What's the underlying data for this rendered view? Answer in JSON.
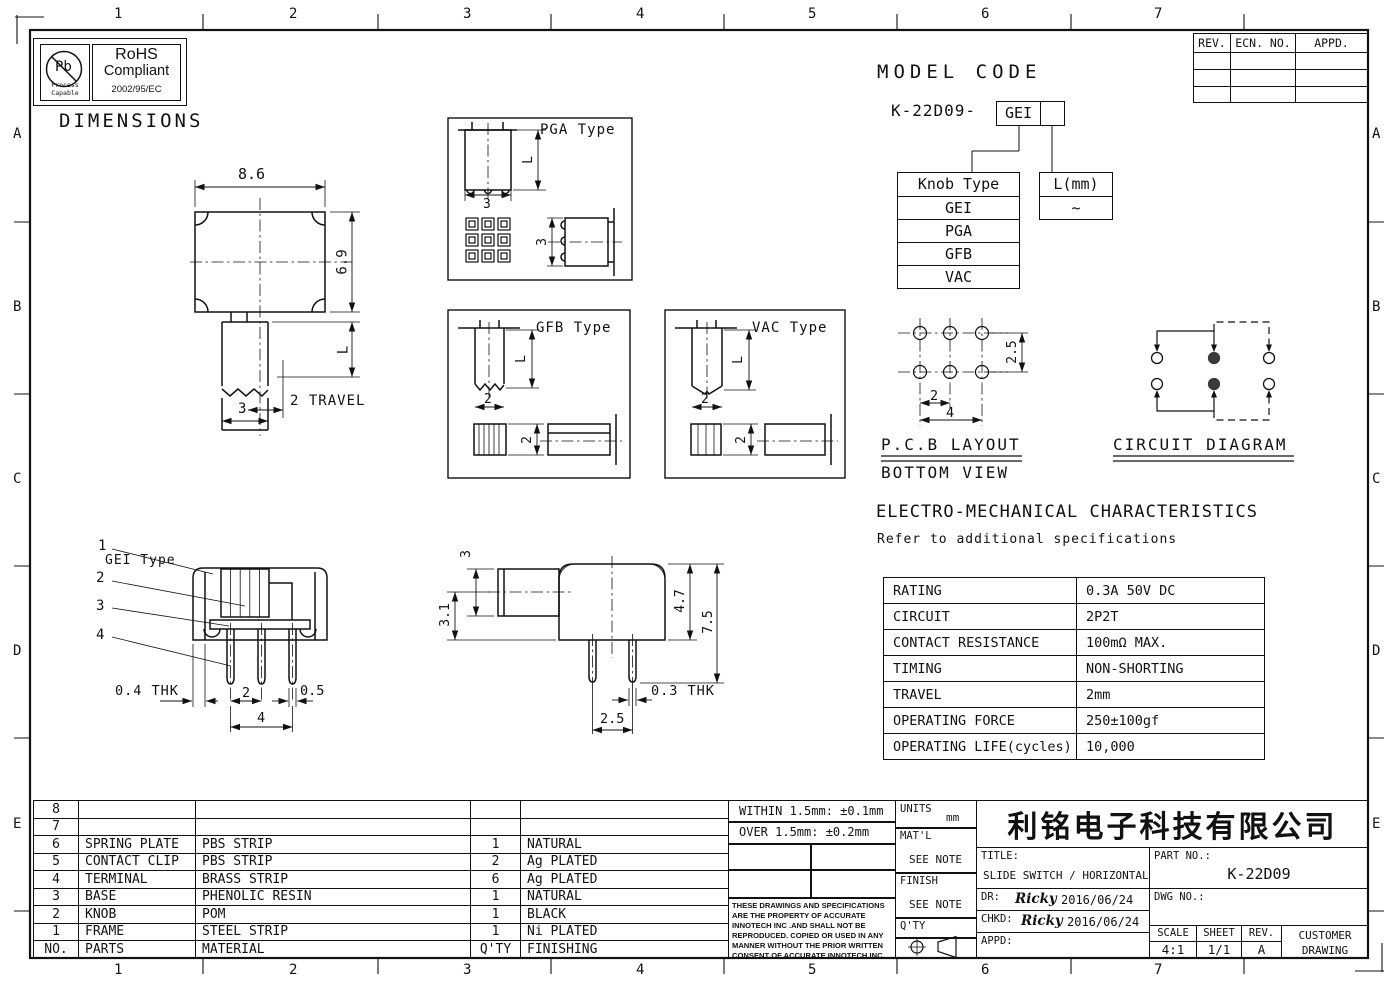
{
  "sheet": {
    "heading": "DIMENSIONS",
    "zone_cols": [
      "1",
      "2",
      "3",
      "4",
      "5",
      "6",
      "7"
    ],
    "zone_rows": [
      "A",
      "B",
      "C",
      "D",
      "E"
    ]
  },
  "rohs": {
    "symbol": "Pb",
    "process": "Process",
    "capable": "Capable",
    "title": "RoHS",
    "subtitle": "Compliant",
    "directive": "2002/95/EC"
  },
  "rev_table": {
    "rev": "REV.",
    "ecn": "ECN. NO.",
    "appd": "APPD."
  },
  "model_code": {
    "heading": "MODEL CODE",
    "base": "K-22D09-",
    "selected_knob": "GEI",
    "knob_table": {
      "header": "Knob Type",
      "options": [
        "GEI",
        "PGA",
        "GFB",
        "VAC"
      ]
    },
    "length_table": {
      "header": "L(mm)",
      "value": "~"
    }
  },
  "views": {
    "top_view": {
      "body_width": "8.6",
      "body_height": "6.9",
      "stem_len": "L",
      "travel": "2 TRAVEL",
      "stem_width": "3"
    },
    "pga": {
      "label": "PGA Type",
      "stem_len": "L",
      "stem_width": "3",
      "side_width": "3"
    },
    "gfb": {
      "label": "GFB Type",
      "stem_len": "L",
      "stem_width": "2",
      "side_width": "2"
    },
    "vac": {
      "label": "VAC Type",
      "stem_len": "L",
      "stem_width": "2",
      "side_width": "2"
    },
    "gei": {
      "label": "GEI Type",
      "c1": "1",
      "c2": "2",
      "c3": "3",
      "c4": "4",
      "frame_thk": "0.4 THK",
      "pin_pitch": "2",
      "pin_width": "0.5",
      "pin_span": "4"
    },
    "side": {
      "knob_h": "3",
      "knob_off": "3.1",
      "body_h": "4.7",
      "total_h": "7.5",
      "pin_thk": "0.3 THK",
      "pin_pitch": "2.5"
    }
  },
  "pcb_layout": {
    "title": "P.C.B LAYOUT",
    "subtitle": "BOTTOM VIEW",
    "row_pitch": "2.5",
    "hole_pitch": "2",
    "hole_span": "4"
  },
  "circuit": {
    "title": "CIRCUIT DIAGRAM"
  },
  "em": {
    "heading": "ELECTRO-MECHANICAL CHARACTERISTICS",
    "subheading": "Refer to additional specifications",
    "rows": [
      {
        "label": "RATING",
        "value": "0.3A 50V DC"
      },
      {
        "label": "CIRCUIT",
        "value": "2P2T"
      },
      {
        "label": "CONTACT RESISTANCE",
        "value": "100mΩ MAX."
      },
      {
        "label": "TIMING",
        "value": "NON-SHORTING"
      },
      {
        "label": "TRAVEL",
        "value": "2mm"
      },
      {
        "label": "OPERATING FORCE",
        "value": "250±100gf"
      },
      {
        "label": "OPERATING LIFE(cycles)",
        "value": "10,000"
      }
    ]
  },
  "parts": {
    "rows": [
      [
        "8",
        "",
        "",
        "",
        ""
      ],
      [
        "7",
        "",
        "",
        "",
        ""
      ],
      [
        "6",
        "SPRING PLATE",
        "PBS STRIP",
        "1",
        "NATURAL"
      ],
      [
        "5",
        "CONTACT CLIP",
        "PBS STRIP",
        "2",
        "Ag PLATED"
      ],
      [
        "4",
        "TERMINAL",
        "BRASS STRIP",
        "6",
        "Ag PLATED"
      ],
      [
        "3",
        "BASE",
        "PHENOLIC RESIN",
        "1",
        "NATURAL"
      ],
      [
        "2",
        "KNOB",
        "POM",
        "1",
        "BLACK"
      ],
      [
        "1",
        "FRAME",
        "STEEL STRIP",
        "1",
        "Ni PLATED"
      ],
      [
        "NO.",
        "PARTS",
        "MATERIAL",
        "Q'TY",
        "FINISHING"
      ]
    ]
  },
  "title_block": {
    "tol_within": "WITHIN 1.5mm: ±0.1mm",
    "tol_over": "OVER 1.5mm: ±0.2mm",
    "units_label": "UNITS",
    "units_value": "mm",
    "matl_label": "MAT'L",
    "matl_value": "SEE NOTE",
    "finish_label": "FINISH",
    "finish_value": "SEE NOTE",
    "qty_label": "Q'TY",
    "disclaimer": "THESE DRAWINGS AND SPECIFICATIONS ARE THE PROPERTY OF ACCURATE INNOTECH INC .AND SHALL NOT BE REPRODUCED. COPIED OR USED IN ANY MANNER WITHOUT THE PRIOR WRITTEN CONSENT OF ACCURATE INNOTECH INC.",
    "company": "利铭电子科技有限公司",
    "title_label": "TITLE:",
    "title_value": "SLIDE SWITCH / HORIZONTAL",
    "part_no_label": "PART NO.:",
    "part_no_value": "K-22D09",
    "dwg_no_label": "DWG NO.:",
    "dr_label": "DR:",
    "dr_sign": "Ricky",
    "dr_date": "2016/06/24",
    "chkd_label": "CHKD:",
    "chkd_sign": "Ricky",
    "chkd_date": "2016/06/24",
    "appd_label": "APPD:",
    "scale_label": "SCALE",
    "scale_value": "4:1",
    "sheet_label": "SHEET",
    "sheet_value": "1/1",
    "rev_label": "REV.",
    "rev_value": "A",
    "customer_line1": "CUSTOMER",
    "customer_line2": "DRAWING"
  }
}
